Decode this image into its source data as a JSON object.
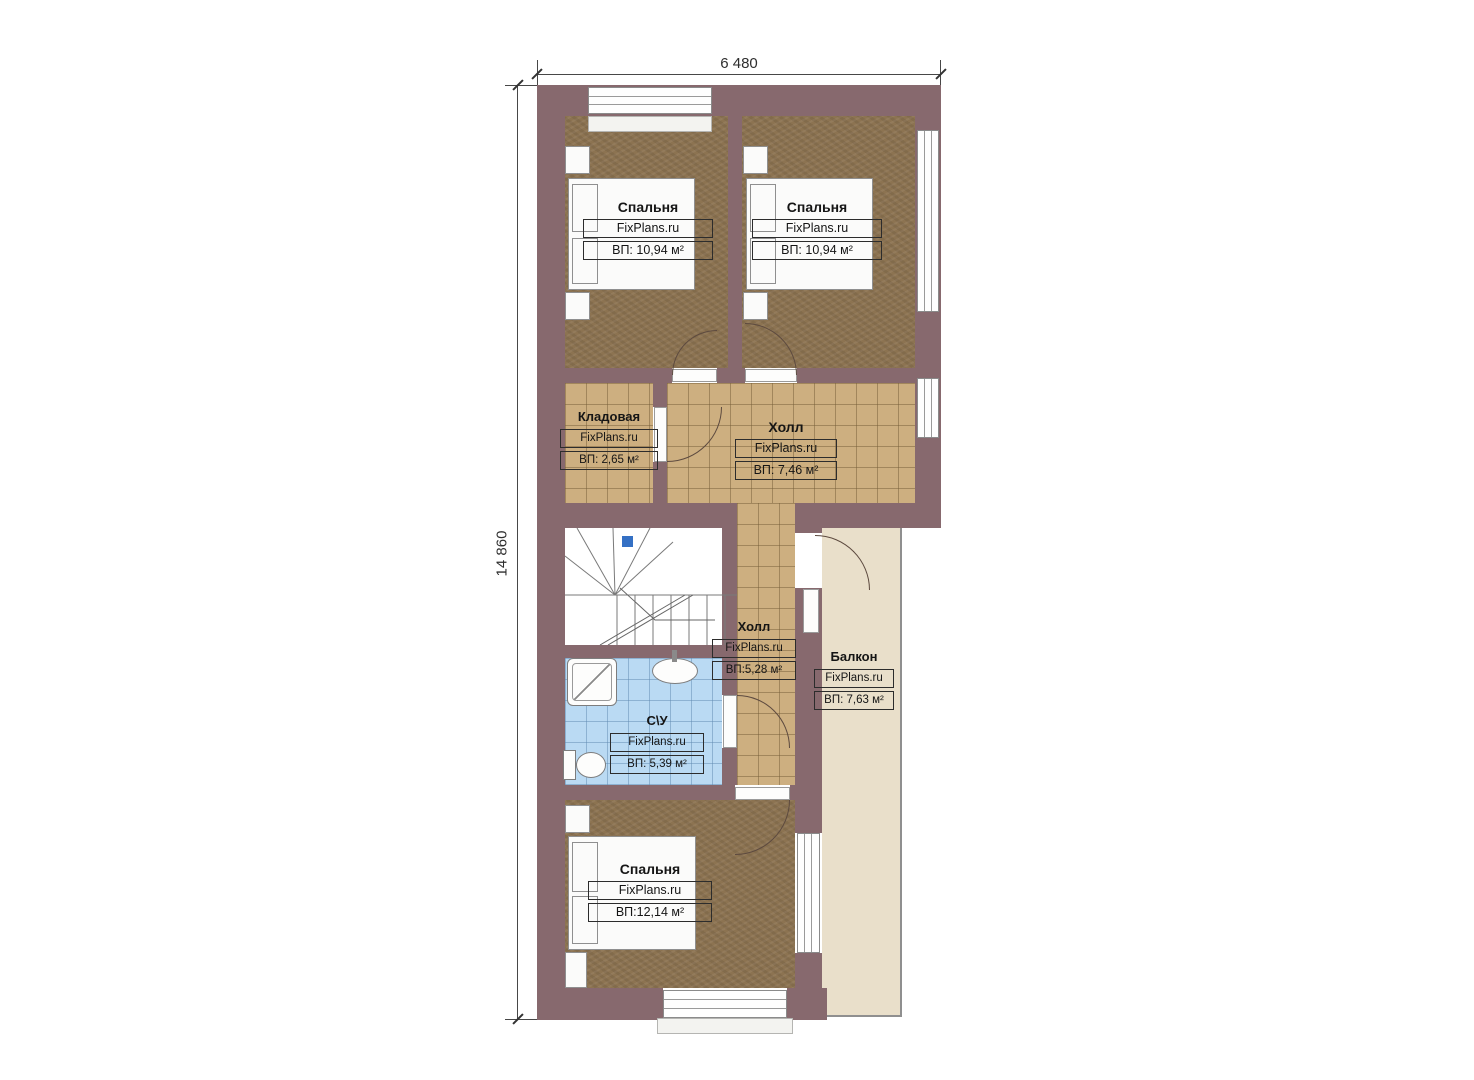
{
  "dimensions": {
    "width": "6 480",
    "height": "14 860"
  },
  "rooms": [
    {
      "id": "bedroom-top-left",
      "name": "Спальня",
      "watermark": "FixPlans.ru",
      "area": "ВП: 10,94 м²"
    },
    {
      "id": "bedroom-top-right",
      "name": "Спальня",
      "watermark": "FixPlans.ru",
      "area": "ВП: 10,94 м²"
    },
    {
      "id": "storage",
      "name": "Кладовая",
      "watermark": "FixPlans.ru",
      "area": "ВП: 2,65 м²"
    },
    {
      "id": "hall-upper",
      "name": "Холл",
      "watermark": "FixPlans.ru",
      "area": "ВП: 7,46 м²"
    },
    {
      "id": "hall-lower",
      "name": "Холл",
      "watermark": "FixPlans.ru",
      "area": "ВП:5,28 м²"
    },
    {
      "id": "balcony",
      "name": "Балкон",
      "watermark": "FixPlans.ru",
      "area": "ВП: 7,63 м²"
    },
    {
      "id": "bathroom",
      "name": "С\\У",
      "watermark": "FixPlans.ru",
      "area": "ВП: 5,39 м²"
    },
    {
      "id": "bedroom-bottom",
      "name": "Спальня",
      "watermark": "FixPlans.ru",
      "area": "ВП:12,14 м²"
    }
  ],
  "colors": {
    "wall": "#87696e",
    "bedroom_floor": "#8c7351",
    "tile_floor": "#cdaf80",
    "bathroom_floor": "#badaf3",
    "balcony_floor": "#e9dfca"
  }
}
